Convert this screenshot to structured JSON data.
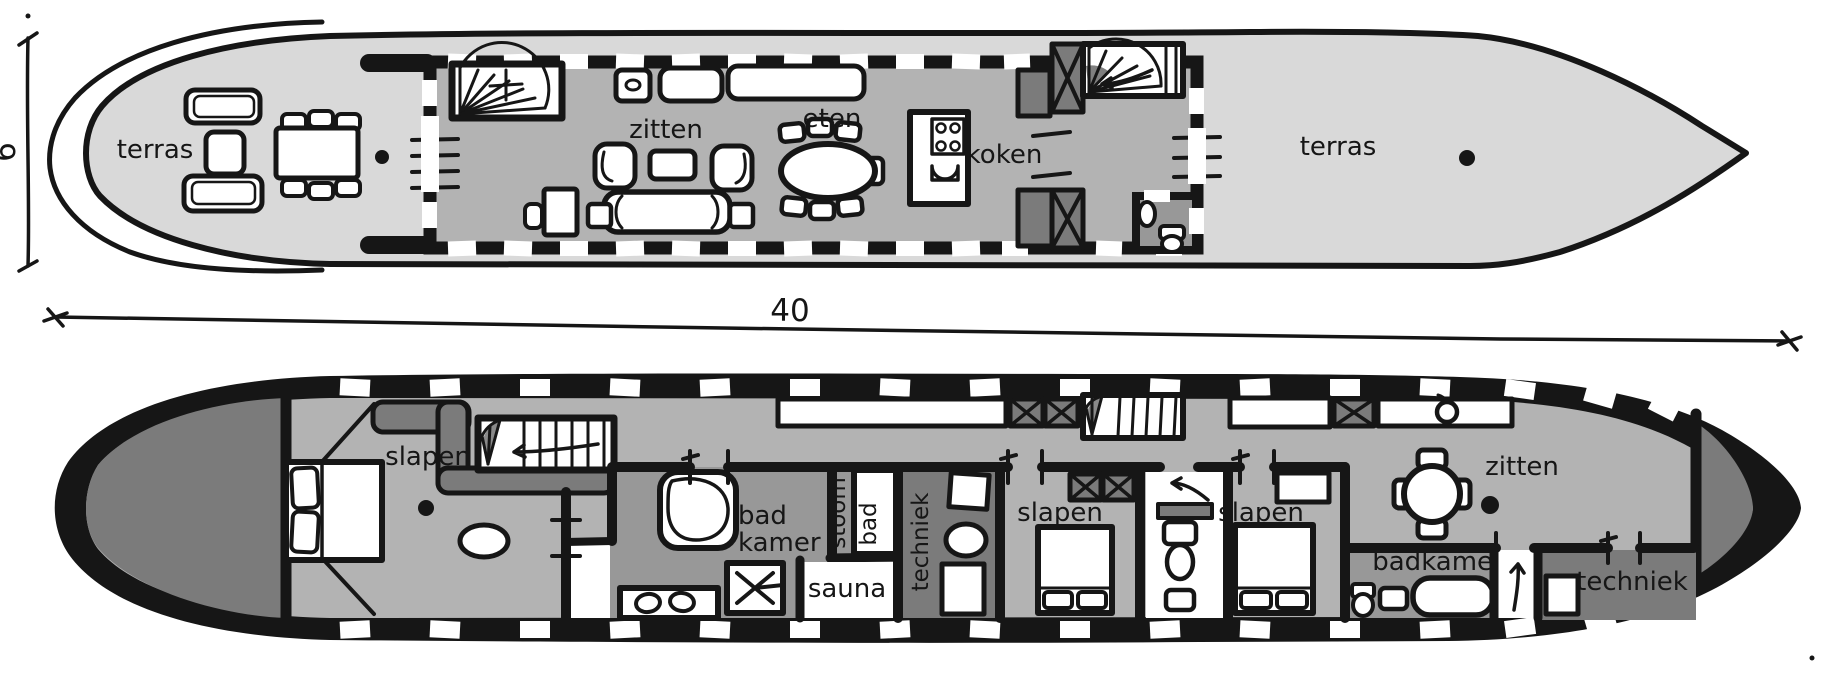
{
  "drawing": {
    "type": "houseboat floor plan sketch",
    "dimensions": {
      "length": "40",
      "width": "6"
    },
    "upper_deck": {
      "rooms": [
        {
          "id": "terras-fore",
          "label": "terras"
        },
        {
          "id": "zitten",
          "label": "zitten"
        },
        {
          "id": "eten",
          "label": "eten"
        },
        {
          "id": "koken",
          "label": "koken"
        },
        {
          "id": "terras-aft",
          "label": "terras"
        }
      ]
    },
    "lower_deck": {
      "rooms": [
        {
          "id": "slapen-fore",
          "label": "slapen"
        },
        {
          "id": "badkamer-fore",
          "label": "bad kamer",
          "line1": "bad",
          "line2": "kamer"
        },
        {
          "id": "stoombad",
          "label": "stoom bad",
          "line1": "stoom",
          "line2": "bad"
        },
        {
          "id": "sauna",
          "label": "sauna"
        },
        {
          "id": "techniek-mid",
          "label": "techniek"
        },
        {
          "id": "slapen-mid",
          "label": "slapen"
        },
        {
          "id": "slapen-aft",
          "label": "slapen"
        },
        {
          "id": "zitten-aft",
          "label": "zitten"
        },
        {
          "id": "badkamer-aft",
          "label": "badkamer"
        },
        {
          "id": "techniek-aft",
          "label": "techniek"
        }
      ]
    },
    "colors": {
      "ink": "#161616",
      "paper": "#ffffff",
      "deck_light": "#d9d9d9",
      "floor_medium": "#b3b3b3",
      "room_medium": "#989898",
      "room_dark": "#7b7b7b"
    }
  }
}
